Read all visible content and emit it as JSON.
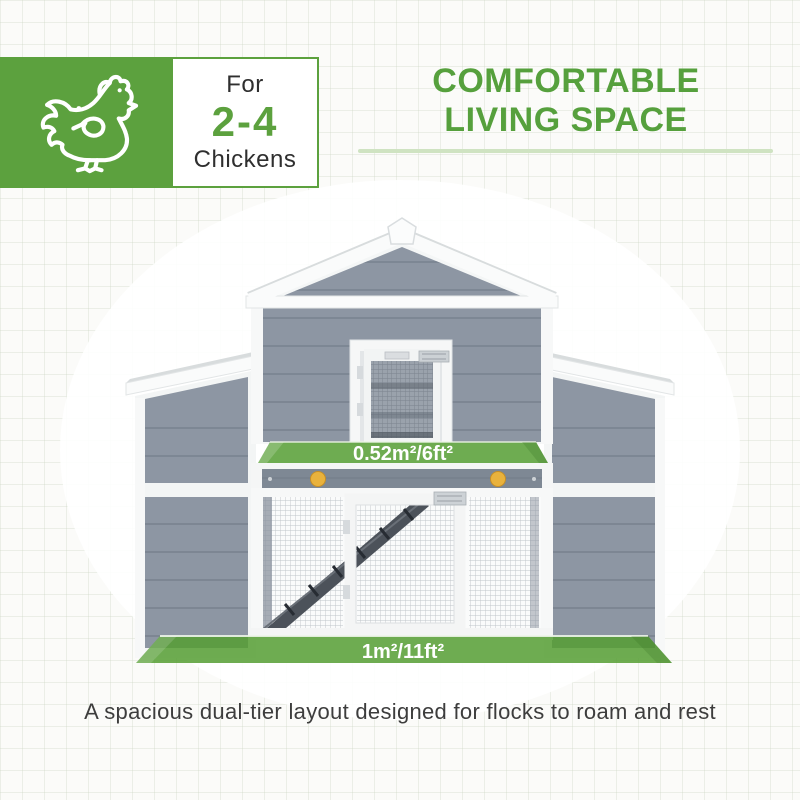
{
  "badge": {
    "icon": "chicken-icon",
    "prefix": "For",
    "range": "2-4",
    "suffix": "Chickens"
  },
  "heading": {
    "line1": "COMFORTABLE",
    "line2": "LIVING SPACE"
  },
  "illustration": {
    "type": "chicken-coop-front-view",
    "upper_area_label": "0.52m²/6ft²",
    "lower_area_label": "1m²/11ft²"
  },
  "caption": "A spacious dual-tier layout designed for flocks to roam and rest",
  "colors": {
    "accent_green": "#5ca13e",
    "underline_green": "#cfe3c2",
    "area_overlay_green": "#559e33",
    "siding_gray": "#8d96a3",
    "stripe_gray": "#7e8894",
    "knob_yellow": "#e9b23c",
    "frame_white": "#f6f7f7",
    "text_dark": "#3d3d3d"
  }
}
